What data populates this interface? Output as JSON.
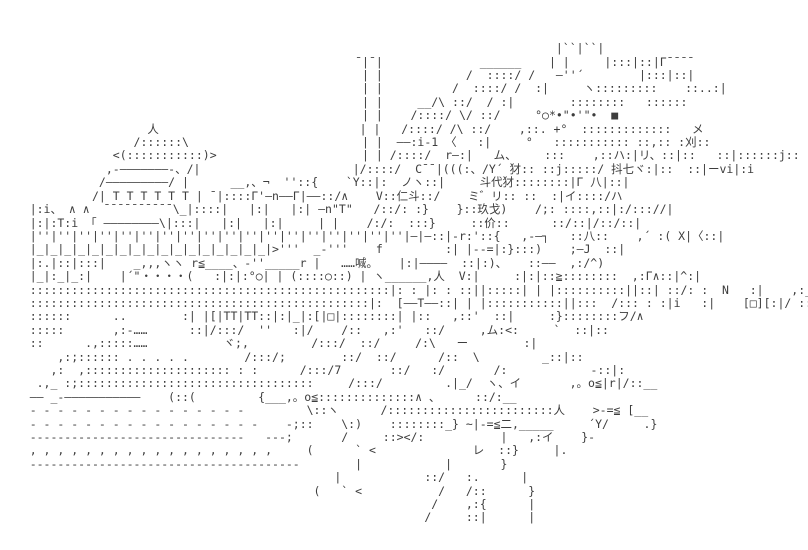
{
  "page": {
    "background_color": "#ffffff",
    "ink_color": "#3d3d3d"
  },
  "artwork": {
    "type": "shift-jis-ascii-art",
    "speech_text": "……喊。",
    "kanji_tokens": [
      "喊",
      "浏",
      "刈",
      "抖",
      "七",
      "斗",
      "代",
      "犲",
      "仁",
      "玖",
      "戈",
      "价",
      "二",
      "人",
      "八",
      "ハ",
      "ム",
      "メ",
      "リ",
      "イ",
      "ヾ",
      "ヽ",
      "レ",
      "Y",
      "N",
      "V"
    ],
    "lines": [
      "",
      "",
      "",
      "                                                                                |``|``|",
      "                                                   ¯|¯|              ______    | |     |:::|::|Γ¯¯¯¯",
      "                                                    | |            /  ::::/ /   ―''´        |:::|::|",
      "                                                    | |          /  ::::/ /  :|     ヽ:::::::::    ::..:|",
      "                                                    | |     __/\\ ::/  / :|        ::::::::   ::::::",
      "                                                    | |    /::::/ \\/ ::/     °○*•\"•'\"•  ■",
      "                     人                             | |   /::::/ /\\ ::/    ,::. +°  :::::::::::::   メ",
      "                   /::::::\\                         | |  ――:i-1 〈   :|     °   ::::::::::: ::,:: :刈::",
      "                <(:::::::::::)>                     | | /::::/  r―:|   ム、    :::    ,::ハ:|リ、::|::   ::|::::::j::",
      "               ,-―――――――-、/|                      |/::::/  C¯¯|(((:、/Y´ 犲:: ::j:::::/ 抖七ヾ:|::  ::|ーvi|:i",
      "              /―――――――――/ |      __,、¬  ''::{    `Y::|:  ノヽ::|     斗代犲::::::::|Γ 八|::|",
      "             /| T T T T T T | ¯|::::Γ'―n――Γ|――::/∧    V::仁斗::/    ミ゛リ:: ::  :|イ::::/ハ",
      "    |:i、 ∧ ∧  ¯¯¯¯¯¯¯¯¯¯\\_|::::|   |:|   |:| ―n\"T\"   /::/: :}    }::玖戈)    /;: ::::,::|:/::://|",
      "    |:|:T:i 「 ――――――――\\|:::|   |:|   |:|     | |    /:/:  :::}     ::价::      ::/::|/::/::|",
      "    |''|''|''|''|''|''|''|''|''|''|''|''|''|''|''|''|''|''|—|—::|-r:'::{   ,-―┐   ::八::    ,´ :( X|〈::|",
      "    |_|_|_|_|_|_|_|_|_|_|_|_|_|_|_|_|_|>'''  _-'''    f         :| |--=|:}:::)    ;―J  ::|",
      "    |:.|::|:::|    _,,,ヽヽ r≦____、-''_____r |   ……喊。   |:|――――  ::|:)、   ::――  ,:/^)",
      "    |_|:_|_:|    |´\"・・・・(   :|:|:°○| | (::::○::) | ヽ______,人  V:|     :|:|::≧::::::::  ,:Γ∧::|^:|",
      "    ::::::::::::::::::::::::::::::::::::::::::::::::::::|: : |: : ::||:::::| | |::::::::::||::| ::/: :  N   :|    ,:__r——|n| ::/ ::/::|(^,",
      "    :::::::::::::::::::::::::::::::::::::::::::::::::|:  [――T――::| | |:::::::::::||:::  /::: : :|i   :|    [□][:|/ ::/  :::|:>",
      "    ::::::      ..        :| |[|TT|TT::|:|_|:[|□|::::::::| |::   ,::'  ::|     :}::::::::フ/∧",
      "    :::::       ,:-……      ::|/:::/  ''   :|/    /::   ,:'   ::/     ,ム:<:     `  ::|::",
      "    ::      .,:::::……           ヾ;,         /:::/  ::/     /:\\   ー        :|",
      "        ,:;:::::: . . . . .        /:::/;        ::/  ::/      /::  \\         _::|::",
      "       ,:  ,::::::::::::::::::::: : :      /:::/7       ::/   :/       /:            -::|:",
      "     .,_ :;::::::::::::::::::::::::::::::::::     /:::/         .|_/  ヽ、イ       ,。o≦|r|/::__",
      "    ―― _-―――――――――――    (::(         {___,。o≦::::::::::::::∧ 、     ::/:__",
      "    - - - - - - - - - - - - - - - -         \\::ヽ      /::::::::::::::::::::::::人    >-=≦ [__",
      "    - - - - - - - - - - - - - - - - -    -;::    \\:)    ::::::::_} ~|-=≦二,_____     ´Y/     .}",
      "    -------------------------------   ---;       /     ::></:           |   ,:イ    }-",
      "    , , , , , , , , , , , , , , , , , ,     (      ` <              レ  ::}     |.",
      "    ---------------------------------------        |            |       }",
      "                                                |            ::/   :.      |",
      "                                             (   ` <           /   /::      }",
      "                                                              /    ,:{      |",
      "                                                             /     ::|      |",
      "",
      ""
    ]
  }
}
